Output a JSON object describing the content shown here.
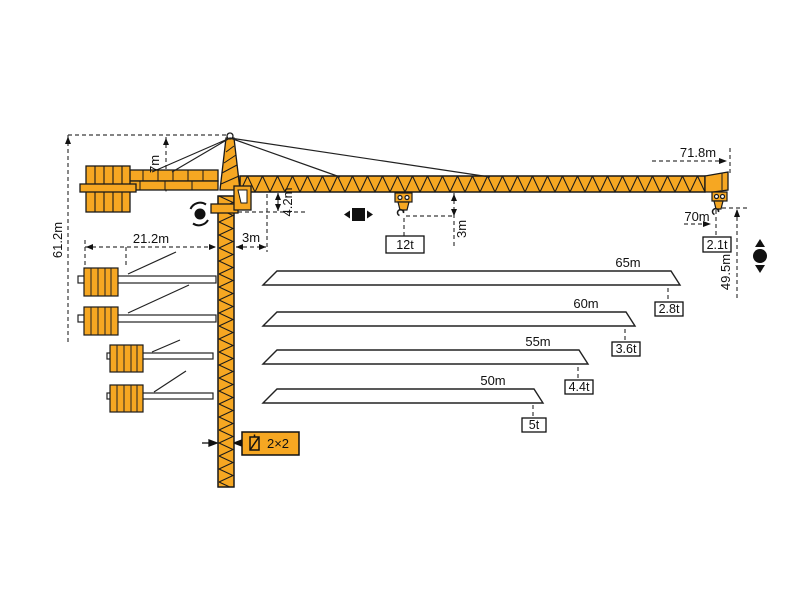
{
  "diagram": {
    "type": "tower-crane-specification-diagram",
    "colors": {
      "crane_orange": "#F6A722",
      "outline": "#1a1a1a",
      "dim_line": "#3a3a3a",
      "white": "#ffffff"
    },
    "dims": {
      "total_height": "61.2m",
      "tower_top_height": "7m",
      "counter_jib_radius": "21.2m",
      "rear_offset": "3m",
      "jib_section_height": "4.2m",
      "hook_drop": "3m",
      "max_radius": "71.8m",
      "tip_radius": "70m",
      "hook_height": "49.5m",
      "mast_section": "2×2",
      "max_capacity": "12t",
      "tip_capacity": "2.1t"
    },
    "variants": [
      {
        "length": "65m",
        "capacity": "2.8t"
      },
      {
        "length": "60m",
        "capacity": "3.6t"
      },
      {
        "length": "55m",
        "capacity": "4.4t"
      },
      {
        "length": "50m",
        "capacity": "5t"
      }
    ],
    "icons": [
      "slewing-icon",
      "trolley-travel-icon",
      "hoist-icon",
      "mast-section-icon"
    ]
  }
}
